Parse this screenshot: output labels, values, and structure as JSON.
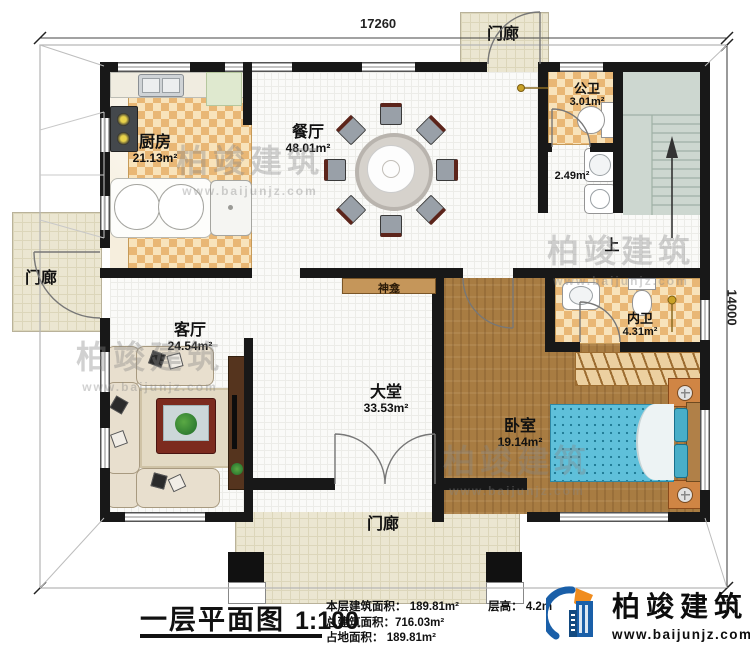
{
  "dimensions": {
    "top": "17260",
    "right": "14000"
  },
  "rooms": {
    "kitchen": {
      "name": "厨房",
      "area": "21.13m²"
    },
    "dining": {
      "name": "餐厅",
      "area": "48.01m²"
    },
    "public_bath": {
      "name": "公卫",
      "area": "3.01m²"
    },
    "vanity": {
      "area": "2.49m²"
    },
    "stairs": {
      "label": "上"
    },
    "ensuite_bath": {
      "name": "内卫",
      "area": "4.31m²"
    },
    "bedroom": {
      "name": "卧室",
      "area": "19.14m²"
    },
    "living": {
      "name": "客厅",
      "area": "24.54m²"
    },
    "hall": {
      "name": "大堂",
      "area": "33.53m²"
    },
    "shrine": {
      "name": "神龛"
    },
    "porch_top": {
      "name": "门廊"
    },
    "porch_left": {
      "name": "门廊"
    },
    "porch_bottom": {
      "name": "门廊"
    }
  },
  "title": {
    "name": "一层平面图",
    "scale": "1:100"
  },
  "stats": {
    "floor_area": "本层建筑面积： 189.81m²",
    "floor_height": "层高： 4.2m",
    "total_area": "总建筑面积：716.03m²",
    "footprint_area": "占地面积： 189.81m²"
  },
  "brand": {
    "name": "柏竣建筑",
    "website": "www.baijunjz.com"
  },
  "watermark": {
    "name": "柏竣建筑",
    "website": "www.baijunjz.com"
  },
  "colors": {
    "wall": "#181818",
    "checker_tan": "#e9b775",
    "wood": "#a87c42",
    "bed_blue": "#5fc0da",
    "brand_blue": "#1a5fa8",
    "brand_orange": "#f08c1e"
  }
}
